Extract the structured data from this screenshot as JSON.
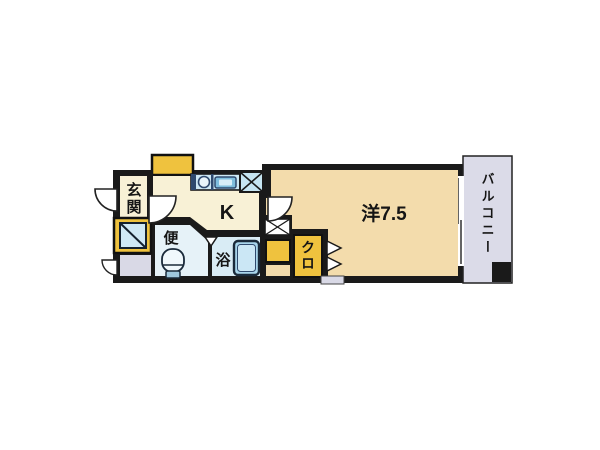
{
  "floorplan": {
    "labels": {
      "entrance": "玄関",
      "kitchen": "K",
      "toilet": "便",
      "bath": "浴",
      "western_room": "洋7.5",
      "closet": "クロ",
      "balcony": "バルコニー"
    },
    "colors": {
      "wall": "#1a1a1a",
      "cream_room": "#F8F1D6",
      "peach_room": "#F3DCAC",
      "toilet_room": "#E6F2F8",
      "bath_room": "#D9ECF5",
      "accent_yellow": "#EFC23E",
      "balcony_gray": "#DBDBE8",
      "gray_box": "#D9D9E6",
      "fixture_blue": "#C6E5F2",
      "fixture_stroke": "#2F4A6E",
      "tub_blue": "#A9D6EC"
    },
    "icon_names": [
      "sink-icon",
      "stove-icon",
      "refrigerator-space-icon",
      "toilet-icon",
      "bathtub-icon",
      "meter-box-icon",
      "door-arc-icon",
      "folding-door-icon",
      "bath-door-icon"
    ]
  }
}
